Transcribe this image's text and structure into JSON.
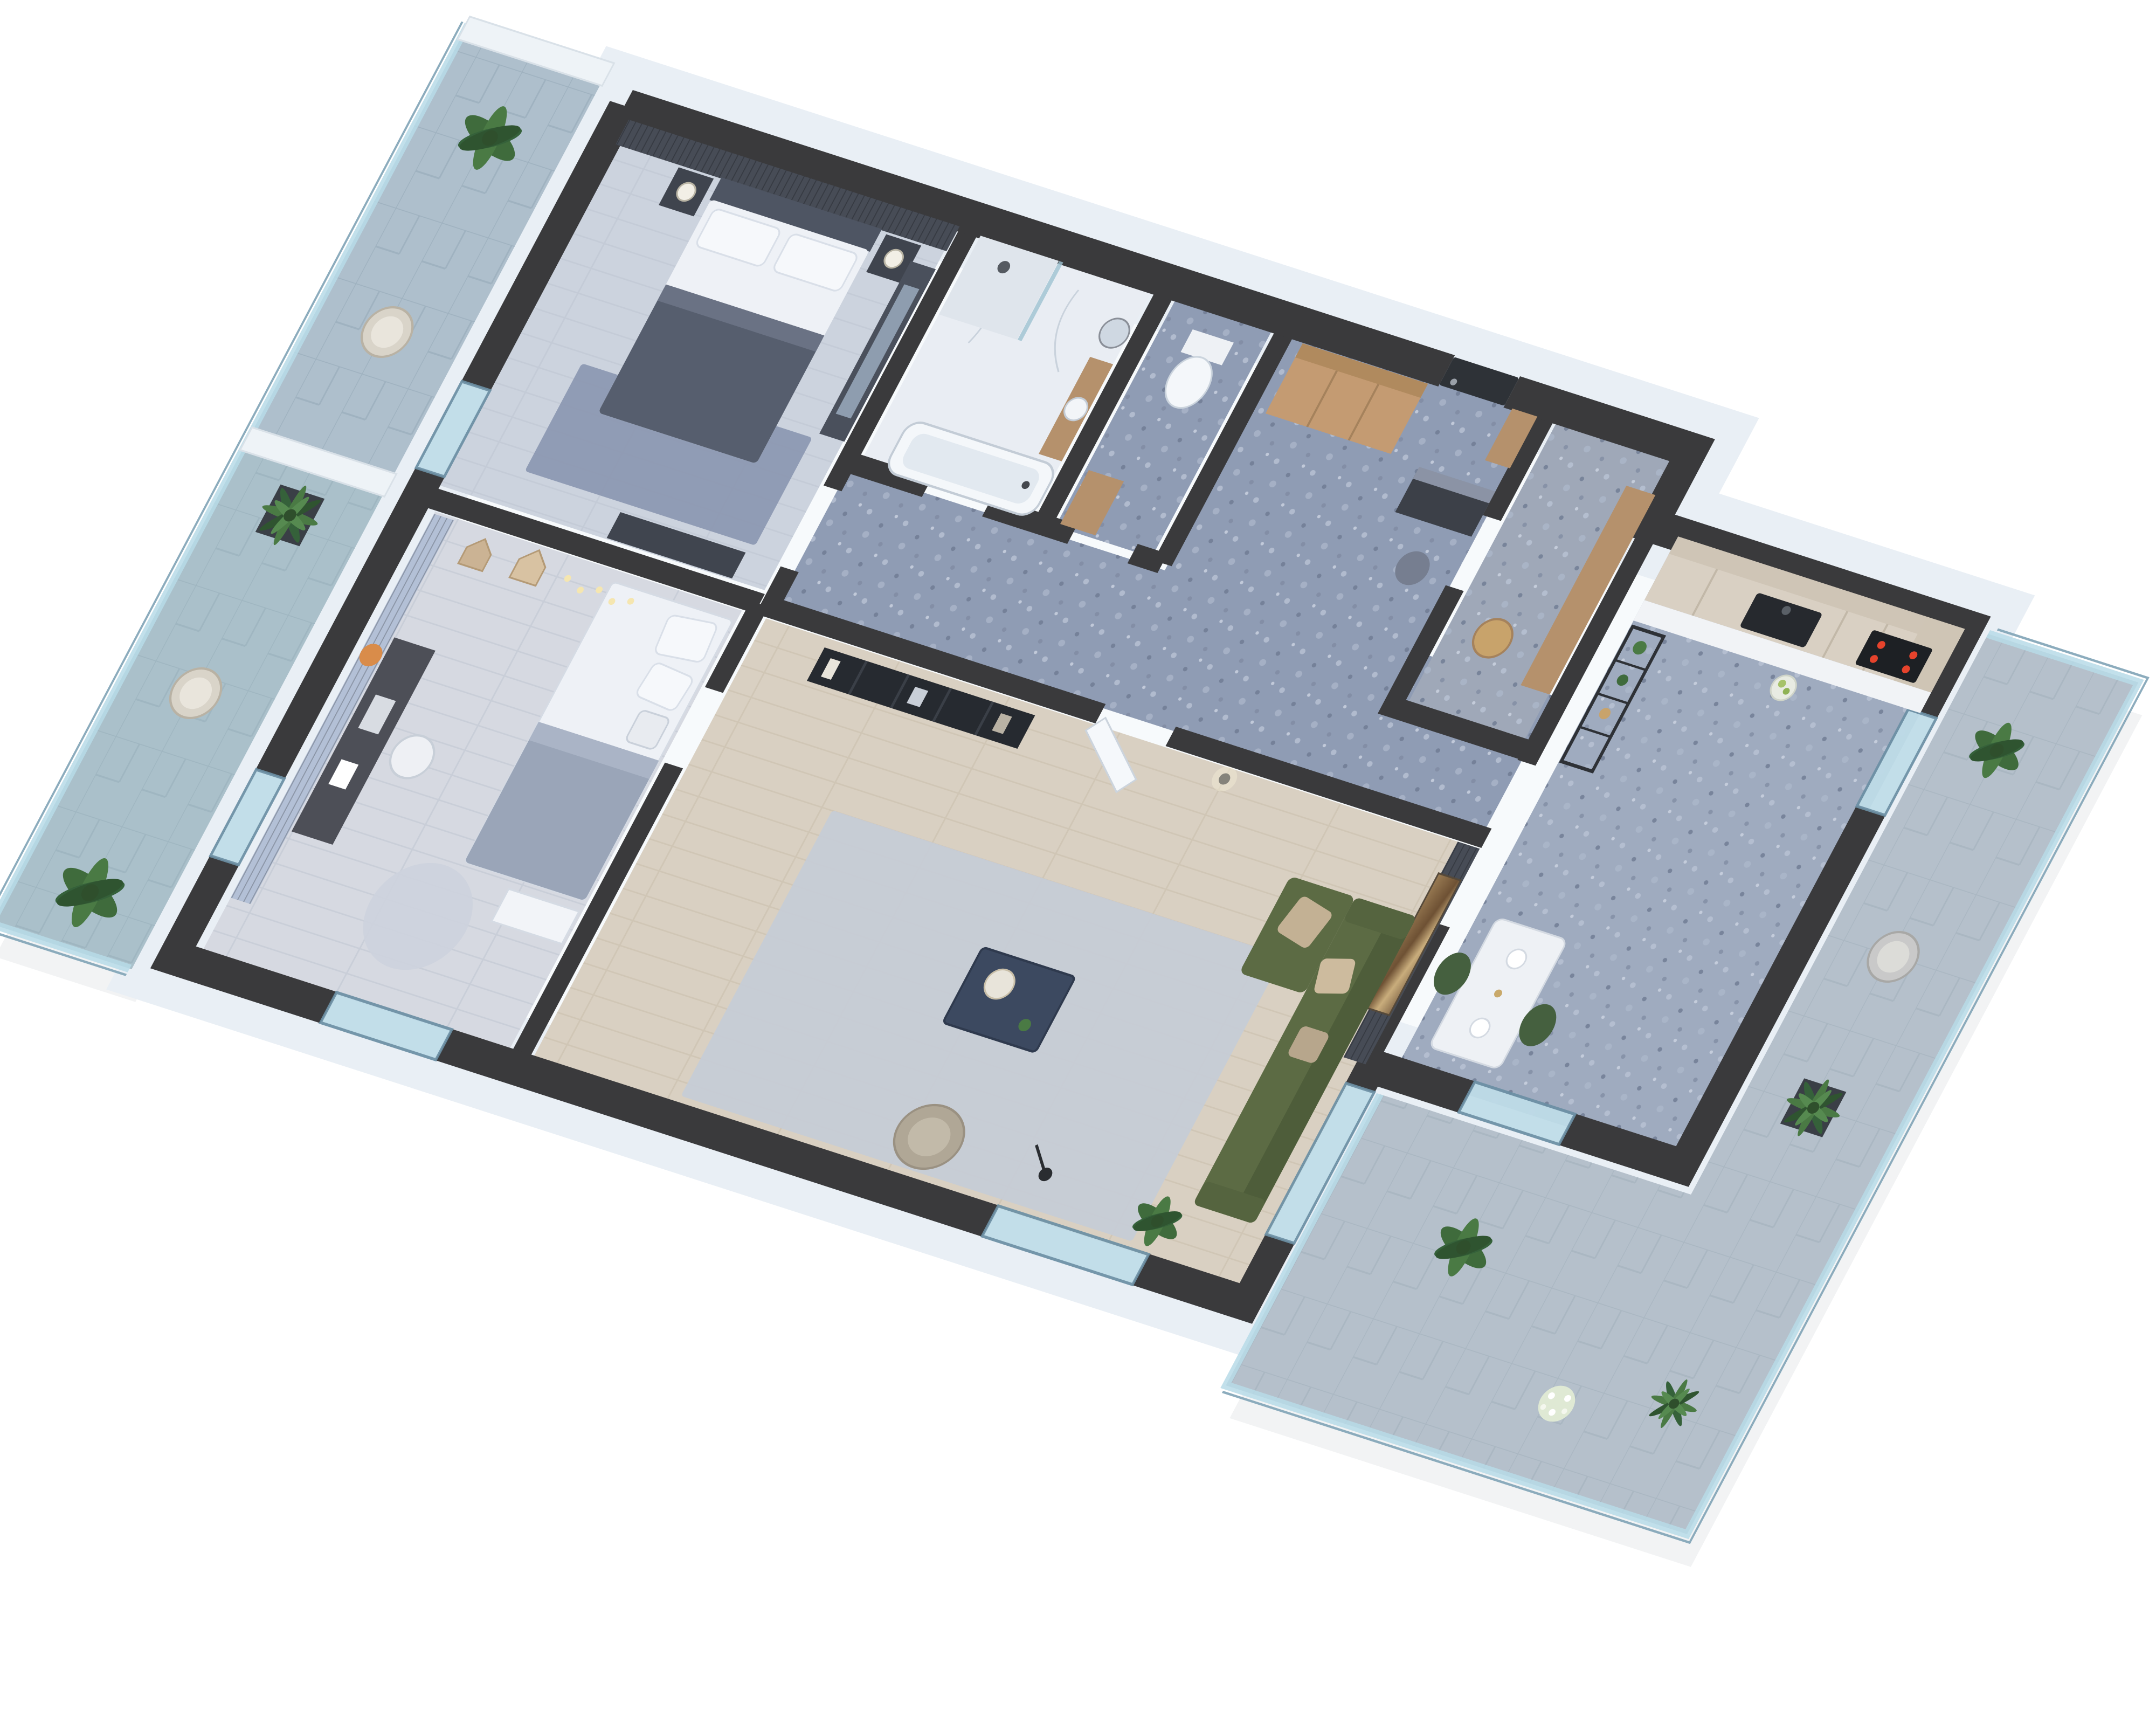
{
  "scene": {
    "type": "isometric-3d-floor-plan-render",
    "description": "Cutaway 3D render of a two-bedroom apartment with charcoal wall tops, white facade, two tiled balconies with glass balustrades and plants",
    "background": "#ffffff"
  },
  "palette": {
    "wall_top": "#3a3a3c",
    "facade": "#e9eff5",
    "glass": "#bfdde9",
    "floor_master": "#ccd3de",
    "floor_kids": "#d6d9e1",
    "floor_living": "#d9d0c2",
    "floor_bath": "#e9edf3",
    "terrazzo_hall": "#8f9cb4",
    "terrazzo_utility": "#9fa8b8",
    "terrazzo_kitchen": "#9fabbf",
    "balcony_tile_left": "#aebfcc",
    "balcony_tile_right": "#b5c0cb",
    "accent_dark": "#474c56",
    "accent_blue": "#b3c0d6",
    "wood_wardrobe": "#c49b72",
    "wood_cabinet": "#b5916c",
    "kitchen_cabinet": "#d9d0c3",
    "counter_white": "#f1f3f6",
    "appliance_dark": "#26292e",
    "hob_red": "#e6432c",
    "sofa_green": "#5c6b44",
    "sofa_green_dark": "#4e5d3a",
    "pillow_beige": "#c3b194",
    "rug_living": "#c6ccd6",
    "rug_master": "#8b97b1",
    "rug_kids": "#cdd3dd",
    "furniture_dark": "#3f444e",
    "bed_white": "#eef1f6",
    "duvet_grey": "#565e6e",
    "blanket_kids": "#9aa5b8",
    "table_navy": "#3c4960",
    "armchair_beige": "#b0a796",
    "chair_green": "#45603f",
    "door_dark": "#2e3237",
    "art_brown": "#8a6f4e",
    "plant_green": "#3f6b3c",
    "pot_dark": "#3a3f46",
    "pot_white": "#e8e8e4",
    "white_paint": "#eef3f7"
  },
  "rooms": [
    {
      "id": "master_bedroom",
      "name": "Master bedroom",
      "furniture": [
        "double bed",
        "dark slat headboard wall",
        "two nightstands",
        "two table lamps",
        "blue-grey area rug",
        "dark dresser",
        "mirrored wardrobe",
        "glass balcony door"
      ]
    },
    {
      "id": "bathroom",
      "name": "Bathroom",
      "furniture": [
        "walk-in shower",
        "bathtub",
        "wood vanity",
        "round mirror",
        "marble walls",
        "terrazzo accent wall"
      ]
    },
    {
      "id": "wc",
      "name": "WC",
      "furniture": [
        "toilet",
        "wood cabinet"
      ]
    },
    {
      "id": "hallway",
      "name": "Entry hall",
      "furniture": [
        "dark entrance door",
        "full-height wood wardrobe",
        "slat coat panel",
        "dark shoe cabinet",
        "grey pouf",
        "blue terrazzo floor"
      ]
    },
    {
      "id": "utility",
      "name": "Utility room",
      "furniture": [
        "terrazzo walls",
        "wood cabinet",
        "woven basket"
      ]
    },
    {
      "id": "kitchen",
      "name": "Kitchen",
      "furniture": [
        "light wood cabinet run",
        "white countertop",
        "dark sink",
        "induction hob with red glow",
        "tall unit",
        "black open shelving with plants",
        "white dining table",
        "two green chairs",
        "glass balcony door"
      ]
    },
    {
      "id": "kids_bedroom",
      "name": "Kids bedroom",
      "furniture": [
        "single bed with grey blanket",
        "pillows",
        "house-shaped wall shelves",
        "string lights",
        "fox wall clock",
        "blue slat accent wall",
        "dark desk",
        "desk chair",
        "round rug",
        "white drawer unit"
      ]
    },
    {
      "id": "living_room",
      "name": "Living room",
      "furniture": [
        "olive green sectional sofa",
        "beige cushions",
        "dark slat accent wall",
        "large abstract wall art",
        "black metal bookshelf",
        "open white door",
        "wall sconce",
        "navy coffee table",
        "light grey rug",
        "beige armchair",
        "black floor lamp",
        "potted banana plant",
        "panoramic window"
      ]
    },
    {
      "id": "balcony_left",
      "name": "Left balcony",
      "furniture": [
        "glass balustrade",
        "stone tile pavers",
        "two wicker chairs",
        "banana plants",
        "palm in dark planter",
        "white partition wall"
      ]
    },
    {
      "id": "balcony_right",
      "name": "Right balcony",
      "furniture": [
        "glass balustrade",
        "stone tile pavers",
        "grey outdoor chair",
        "fiddle-leaf fig in white pot",
        "fiddle-leaf fig in dark pot",
        "palm plants",
        "white ornamental grass"
      ]
    }
  ]
}
